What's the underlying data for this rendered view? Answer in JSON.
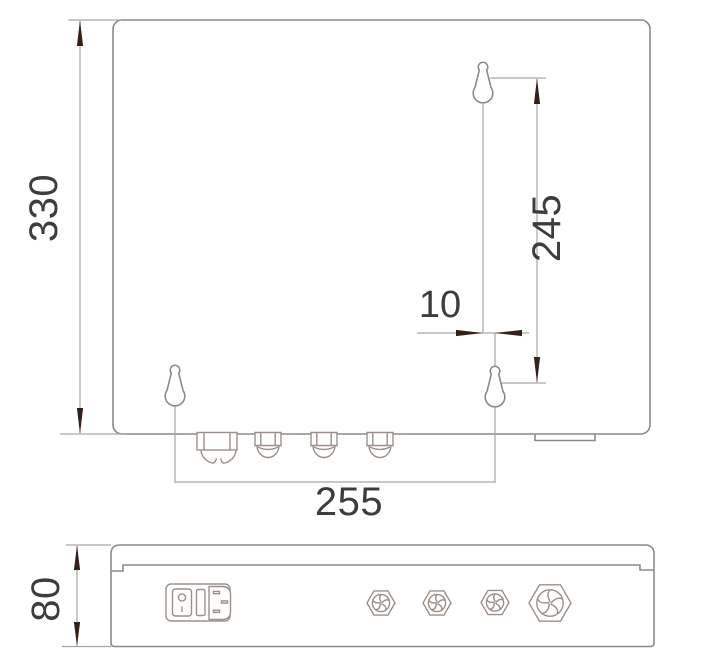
{
  "colors": {
    "background": "#ffffff",
    "outline": "#8a8a8a",
    "component": "#9b9089",
    "dimension": "#a6a6a6",
    "arrow": "#33211a",
    "text": "#3d3d3d"
  },
  "front_view": {
    "dims": {
      "height": "330",
      "hole_spacing_vertical": "245",
      "hole_offset": "10",
      "hole_spacing_horizontal": "255"
    }
  },
  "bottom_view": {
    "dims": {
      "depth": "80"
    }
  }
}
